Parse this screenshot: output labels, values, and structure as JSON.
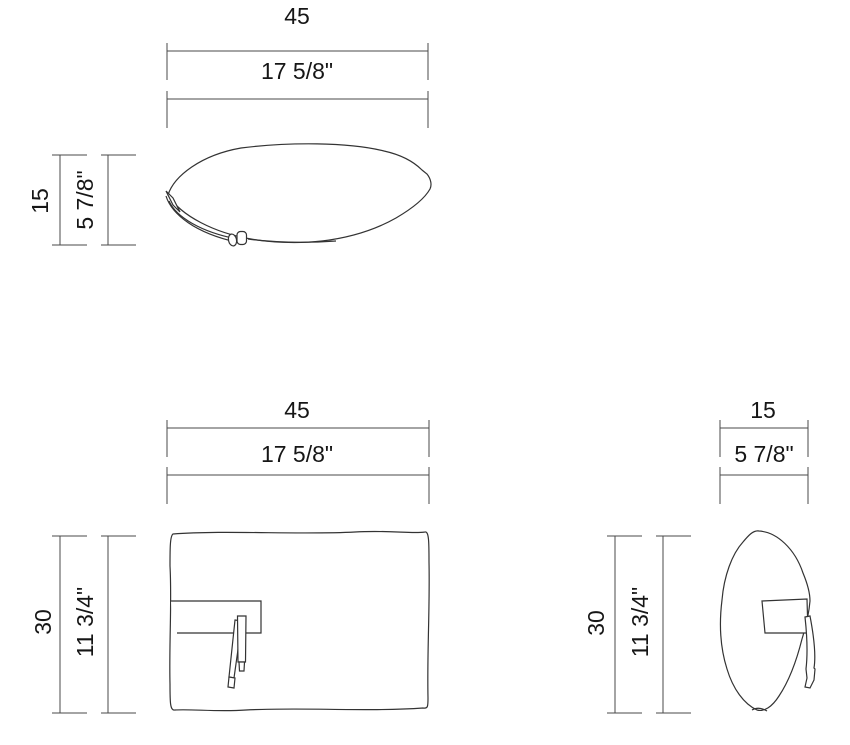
{
  "title": "Pillow dimensional drawing",
  "colors": {
    "background": "#ffffff",
    "line": "#333333",
    "dimension_line": "#4a4a4a",
    "text": "#161616"
  },
  "views": {
    "top": {
      "name": "top view",
      "width_metric": "45",
      "width_imperial": "17 5/8\"",
      "depth_metric": "15",
      "depth_imperial": "5 7/8\""
    },
    "front": {
      "name": "front view",
      "width_metric": "45",
      "width_imperial": "17 5/8\"",
      "height_metric": "30",
      "height_imperial": "11 3/4\""
    },
    "side": {
      "name": "side view",
      "depth_metric": "15",
      "depth_imperial": "5 7/8\"",
      "height_metric": "30",
      "height_imperial": "11 3/4\""
    }
  }
}
